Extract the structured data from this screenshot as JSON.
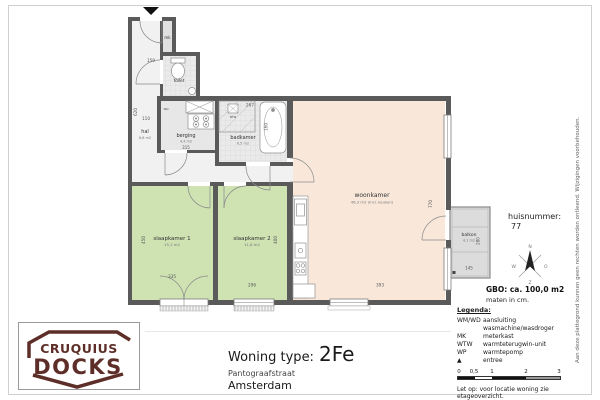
{
  "colors": {
    "wall": "#5a5a5a",
    "bedroom_fill": "#cee2b2",
    "living_fill": "#f9e8da",
    "tile_fill": "#eaeaea",
    "balkon_fill": "#dcdcdc",
    "logo": "#5d2e28",
    "entree_marker": "#111111"
  },
  "plan": {
    "rooms": {
      "hal": {
        "name": "hal",
        "area": "6,6 m2"
      },
      "toilet": {
        "name": "toilet"
      },
      "berging": {
        "name": "berging",
        "area": "4,4 m2"
      },
      "badkamer": {
        "name": "badkamer",
        "area": "6,5 m2"
      },
      "woonkamer": {
        "name": "woonkamer",
        "area": "46,3 m2 (incl. keuken)"
      },
      "slaapkamer1": {
        "name": "slaapkamer 1",
        "area": "15,1 m2"
      },
      "slaapkamer2": {
        "name": "slaapkamer 2",
        "area": "11,8 m2"
      },
      "balkon": {
        "name": "balkon",
        "area": "4,1 m2"
      }
    },
    "labels": {
      "mk": "mk",
      "wp": "wp",
      "wtw": "wtw"
    },
    "dims": {
      "entree_width": "150",
      "hal_length": "620",
      "hal_width": "110",
      "berging_width": "315",
      "badkamer_width": "267",
      "badkamer_depth": "160",
      "sk1_depth": "450",
      "sk1_width": "335",
      "sk2_depth": "400",
      "sk2_width": "296",
      "wk_width": "393",
      "wk_depth": "770",
      "balkon_width": "145",
      "balkon_depth": "280"
    }
  },
  "compass": {
    "n": "N",
    "o": "O",
    "z": "Z",
    "w": "W"
  },
  "info": {
    "huisnummer_label": "huisnummer:",
    "huisnummer_value": "77",
    "gbo": "GBO: ca. 100,0 m2",
    "maten": "maten in cm."
  },
  "legend": {
    "title": "Legenda:",
    "items": [
      {
        "abbr": "WM/WD",
        "desc": "aansluiting wasmachine/wasdroger"
      },
      {
        "abbr": "MK",
        "desc": "meterkast"
      },
      {
        "abbr": "WTW",
        "desc": "warmteterugwin-unit"
      },
      {
        "abbr": "WP",
        "desc": "warmtepomp"
      },
      {
        "abbr": "▲",
        "desc": "entree"
      }
    ],
    "scale_ticks": [
      "0",
      "0,5",
      "1",
      "2",
      "3"
    ],
    "note": "Let op:  voor locatie woning zie etageoverzicht."
  },
  "title_block": {
    "label": "Woning type:",
    "type": "2Fe",
    "street": "Pantograafstraat",
    "city": "Amsterdam"
  },
  "logo": {
    "top": "CRUQUIUS",
    "bottom": "DOCKS"
  },
  "disclaimer": "Aan deze plattegrond kunnen geen rechten worden ontleend. Wijzigingen voorbehouden."
}
